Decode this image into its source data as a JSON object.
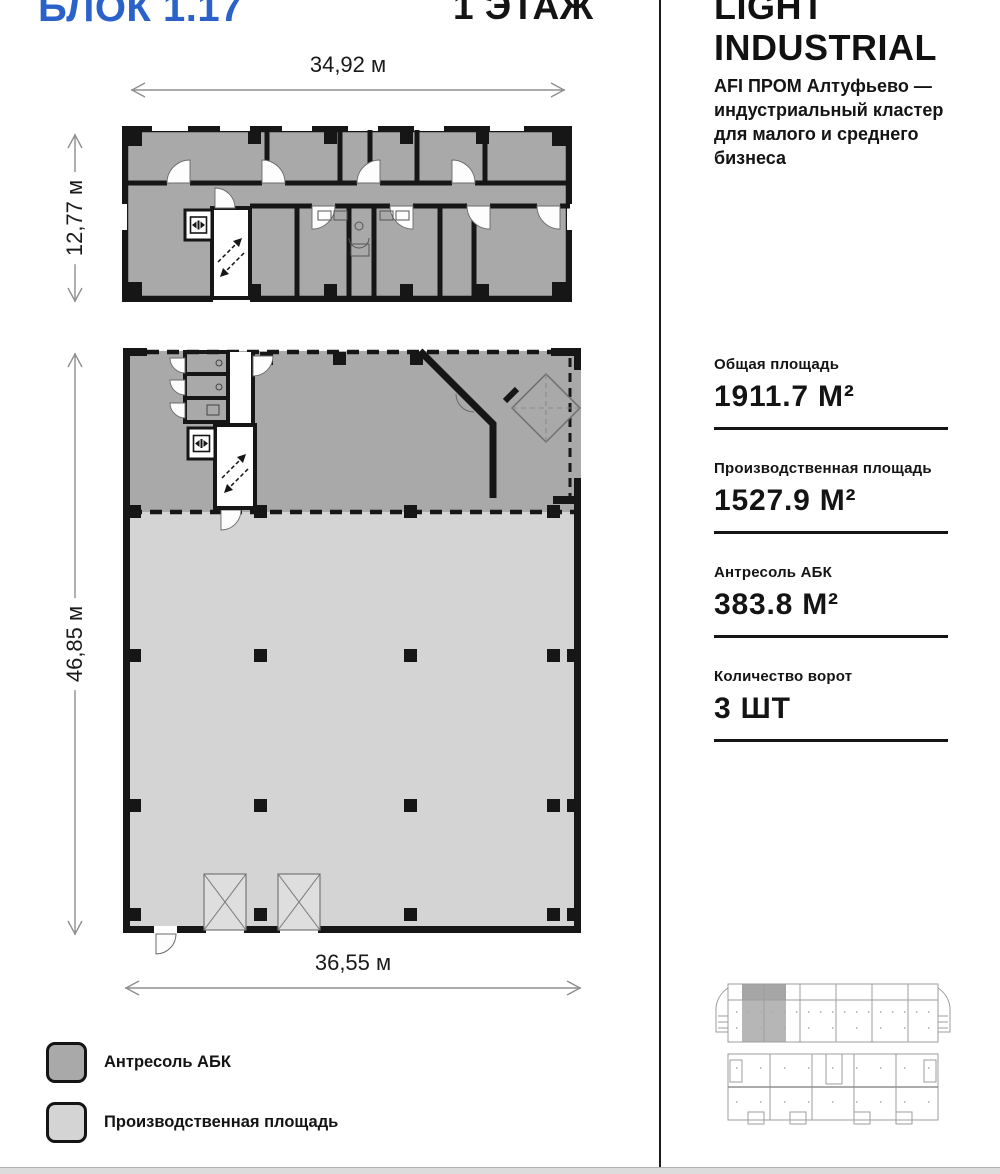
{
  "page": {
    "block_title": "БЛОК 1.17",
    "floor_title": "1 ЭТАЖ"
  },
  "sidebar": {
    "brand": {
      "line1": "LIGHT",
      "line2": "INDUSTRIAL"
    },
    "description": "AFI ПРОМ Алтуфьево — индустриальный кластер для малого и среднего бизнеса",
    "stats": [
      {
        "label": "Общая площадь",
        "value": "1911.7 М²"
      },
      {
        "label": "Производственная площадь",
        "value": "1527.9 М²"
      },
      {
        "label": "Антресоль АБК",
        "value": "383.8 М²"
      },
      {
        "label": "Количество ворот",
        "value": "3 ШТ"
      }
    ]
  },
  "plan": {
    "top_plan": {
      "width_label": "34,92 м",
      "height_label": "12,77 м"
    },
    "bottom_plan": {
      "height_label": "46,85 м",
      "width_label": "36,55 м"
    }
  },
  "legend": {
    "items": [
      {
        "label": "Антресоль АБК",
        "color": "#a9a9a9"
      },
      {
        "label": "Производственная площадь",
        "color": "#d4d4d4"
      }
    ]
  },
  "colors": {
    "accent_blue": "#2b62c9",
    "mezzanine_gray": "#a9a9a9",
    "production_gray": "#d4d4d4",
    "wall_black": "#161616"
  }
}
